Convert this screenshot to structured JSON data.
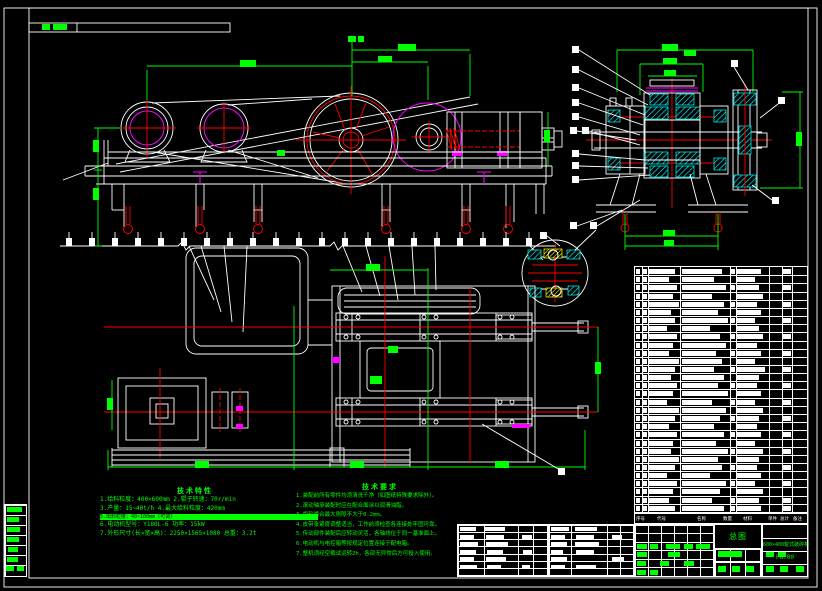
{
  "colors": {
    "line": "#ffffff",
    "dimension": "#00ff00",
    "centerline": "#ff0000",
    "accent": "#ff00ff",
    "hatch": "#00ffff",
    "hatch_alt": "#ffff00",
    "background": "#000000"
  },
  "tech_req": {
    "title": "技术要求",
    "lines": [
      "1.装配前所有零件均须清洗干净（如图纸特殊要求除外）。",
      "2.滚动轴承装配时应在配合面涂以润滑油脂。",
      "3.齿轮啮合最大侧隙不大于0.2mm。",
      "4.皮带张紧度调整适当，工作前须检查各连接处牢固可靠。",
      "5.传动部件装配后应转动灵活，各轴线位于同一基准面上。",
      "6.电动机与电控箱等按规定位置连接于配电箱。",
      "7.整机须经空载试运转2h，各部无异常后方可投入使用。"
    ]
  },
  "tech_spec": {
    "title": "技术特性",
    "line1": "1.给料粒度：400×600mm   2.辊子转速：70r/min",
    "line2": "3.产量：15~40t/h   4.最大给料粒度：420mm",
    "bar_text": "5.出料粒度：40~100mm（可调）",
    "line3": "6.电动机型号：Y180L-6   功率：15kW",
    "line4": "7.外形尺寸(长×宽×高)：2250×1565×1080  总重：3.2t"
  },
  "title_block": {
    "name_cell": "总图",
    "product": "600×400辊式破碎机",
    "code": "PG.00"
  },
  "bom": {
    "header": [
      "序号",
      "代号",
      "名称",
      "数量",
      "材料",
      "单件",
      "总计",
      "备注"
    ],
    "rows": [
      [
        26,
        40,
        24,
        8
      ],
      [
        20,
        32,
        18,
        0
      ],
      [
        28,
        44,
        22,
        8
      ],
      [
        24,
        30,
        26,
        0
      ],
      [
        30,
        42,
        20,
        8
      ],
      [
        22,
        36,
        24,
        0
      ],
      [
        26,
        46,
        18,
        8
      ],
      [
        18,
        28,
        22,
        0
      ],
      [
        28,
        38,
        26,
        8
      ],
      [
        24,
        44,
        20,
        0
      ],
      [
        20,
        34,
        24,
        8
      ],
      [
        30,
        40,
        18,
        0
      ],
      [
        26,
        32,
        28,
        8
      ],
      [
        22,
        42,
        22,
        0
      ],
      [
        28,
        36,
        20,
        8
      ],
      [
        24,
        46,
        24,
        0
      ],
      [
        18,
        30,
        18,
        8
      ],
      [
        30,
        44,
        26,
        0
      ],
      [
        26,
        38,
        22,
        8
      ],
      [
        20,
        32,
        20,
        0
      ],
      [
        28,
        42,
        24,
        8
      ],
      [
        24,
        34,
        18,
        0
      ],
      [
        22,
        46,
        26,
        8
      ],
      [
        30,
        36,
        22,
        0
      ],
      [
        26,
        40,
        20,
        8
      ],
      [
        18,
        28,
        24,
        0
      ],
      [
        28,
        44,
        18,
        8
      ],
      [
        24,
        38,
        26,
        0
      ],
      [
        20,
        30,
        22,
        8
      ],
      [
        26,
        42,
        24,
        8
      ]
    ]
  },
  "redactions": [
    {
      "x": 42,
      "y": 24,
      "w": 8,
      "h": 6,
      "c": "g"
    },
    {
      "x": 53,
      "y": 24,
      "w": 14,
      "h": 6,
      "c": "g"
    },
    {
      "x": 460,
      "y": 527,
      "w": 16,
      "h": 4,
      "c": "w"
    },
    {
      "x": 485,
      "y": 527,
      "w": 20,
      "h": 4,
      "c": "w"
    },
    {
      "x": 460,
      "y": 535,
      "w": 14,
      "h": 4,
      "c": "w"
    },
    {
      "x": 486,
      "y": 535,
      "w": 18,
      "h": 4,
      "c": "w"
    },
    {
      "x": 522,
      "y": 535,
      "w": 10,
      "h": 4,
      "c": "w"
    },
    {
      "x": 460,
      "y": 542,
      "w": 18,
      "h": 4,
      "c": "w"
    },
    {
      "x": 486,
      "y": 542,
      "w": 22,
      "h": 4,
      "c": "w"
    },
    {
      "x": 460,
      "y": 550,
      "w": 16,
      "h": 4,
      "c": "w"
    },
    {
      "x": 487,
      "y": 550,
      "w": 16,
      "h": 4,
      "c": "w"
    },
    {
      "x": 523,
      "y": 550,
      "w": 9,
      "h": 4,
      "c": "w"
    },
    {
      "x": 460,
      "y": 557,
      "w": 14,
      "h": 4,
      "c": "w"
    },
    {
      "x": 486,
      "y": 557,
      "w": 20,
      "h": 4,
      "c": "w"
    },
    {
      "x": 460,
      "y": 565,
      "w": 17,
      "h": 4,
      "c": "w"
    },
    {
      "x": 487,
      "y": 565,
      "w": 14,
      "h": 4,
      "c": "w"
    },
    {
      "x": 522,
      "y": 565,
      "w": 8,
      "h": 4,
      "c": "w"
    },
    {
      "x": 551,
      "y": 527,
      "w": 18,
      "h": 4,
      "c": "w"
    },
    {
      "x": 575,
      "y": 527,
      "w": 22,
      "h": 4,
      "c": "w"
    },
    {
      "x": 551,
      "y": 535,
      "w": 14,
      "h": 4,
      "c": "w"
    },
    {
      "x": 576,
      "y": 535,
      "w": 18,
      "h": 4,
      "c": "w"
    },
    {
      "x": 612,
      "y": 535,
      "w": 10,
      "h": 4,
      "c": "w"
    },
    {
      "x": 551,
      "y": 542,
      "w": 16,
      "h": 4,
      "c": "w"
    },
    {
      "x": 575,
      "y": 542,
      "w": 24,
      "h": 4,
      "c": "w"
    },
    {
      "x": 551,
      "y": 550,
      "w": 12,
      "h": 4,
      "c": "w"
    },
    {
      "x": 576,
      "y": 550,
      "w": 18,
      "h": 4,
      "c": "w"
    },
    {
      "x": 551,
      "y": 557,
      "w": 16,
      "h": 4,
      "c": "w"
    },
    {
      "x": 612,
      "y": 557,
      "w": 12,
      "h": 4,
      "c": "w"
    },
    {
      "x": 551,
      "y": 565,
      "w": 14,
      "h": 4,
      "c": "w"
    },
    {
      "x": 576,
      "y": 565,
      "w": 20,
      "h": 4,
      "c": "w"
    },
    {
      "x": 637,
      "y": 544,
      "w": 10,
      "h": 5,
      "c": "g"
    },
    {
      "x": 650,
      "y": 544,
      "w": 8,
      "h": 5,
      "c": "g"
    },
    {
      "x": 666,
      "y": 544,
      "w": 14,
      "h": 5,
      "c": "g"
    },
    {
      "x": 684,
      "y": 544,
      "w": 9,
      "h": 5,
      "c": "g"
    },
    {
      "x": 696,
      "y": 544,
      "w": 14,
      "h": 5,
      "c": "g"
    },
    {
      "x": 637,
      "y": 552,
      "w": 10,
      "h": 5,
      "c": "g"
    },
    {
      "x": 668,
      "y": 552,
      "w": 12,
      "h": 5,
      "c": "g"
    },
    {
      "x": 637,
      "y": 561,
      "w": 9,
      "h": 5,
      "c": "g"
    },
    {
      "x": 660,
      "y": 561,
      "w": 9,
      "h": 5,
      "c": "g"
    },
    {
      "x": 684,
      "y": 561,
      "w": 10,
      "h": 5,
      "c": "g"
    },
    {
      "x": 637,
      "y": 570,
      "w": 9,
      "h": 5,
      "c": "g"
    },
    {
      "x": 650,
      "y": 570,
      "w": 8,
      "h": 5,
      "c": "g"
    },
    {
      "x": 718,
      "y": 551,
      "w": 24,
      "h": 6,
      "c": "g"
    },
    {
      "x": 766,
      "y": 552,
      "w": 8,
      "h": 5,
      "c": "g"
    },
    {
      "x": 778,
      "y": 552,
      "w": 8,
      "h": 5,
      "c": "g"
    },
    {
      "x": 718,
      "y": 566,
      "w": 8,
      "h": 6,
      "c": "g"
    },
    {
      "x": 732,
      "y": 566,
      "w": 8,
      "h": 6,
      "c": "g"
    },
    {
      "x": 746,
      "y": 566,
      "w": 8,
      "h": 6,
      "c": "g"
    },
    {
      "x": 766,
      "y": 566,
      "w": 8,
      "h": 6,
      "c": "g"
    },
    {
      "x": 780,
      "y": 566,
      "w": 8,
      "h": 6,
      "c": "g"
    },
    {
      "x": 796,
      "y": 566,
      "w": 8,
      "h": 6,
      "c": "g"
    },
    {
      "x": 7,
      "y": 507,
      "w": 15,
      "h": 5,
      "c": "g"
    },
    {
      "x": 7,
      "y": 517,
      "w": 12,
      "h": 5,
      "c": "g"
    },
    {
      "x": 7,
      "y": 527,
      "w": 13,
      "h": 5,
      "c": "g"
    },
    {
      "x": 7,
      "y": 537,
      "w": 12,
      "h": 5,
      "c": "g"
    },
    {
      "x": 8,
      "y": 547,
      "w": 10,
      "h": 5,
      "c": "g"
    },
    {
      "x": 7,
      "y": 557,
      "w": 11,
      "h": 5,
      "c": "g"
    },
    {
      "x": 6,
      "y": 566,
      "w": 8,
      "h": 5,
      "c": "g"
    },
    {
      "x": 17,
      "y": 566,
      "w": 7,
      "h": 5,
      "c": "g"
    }
  ]
}
